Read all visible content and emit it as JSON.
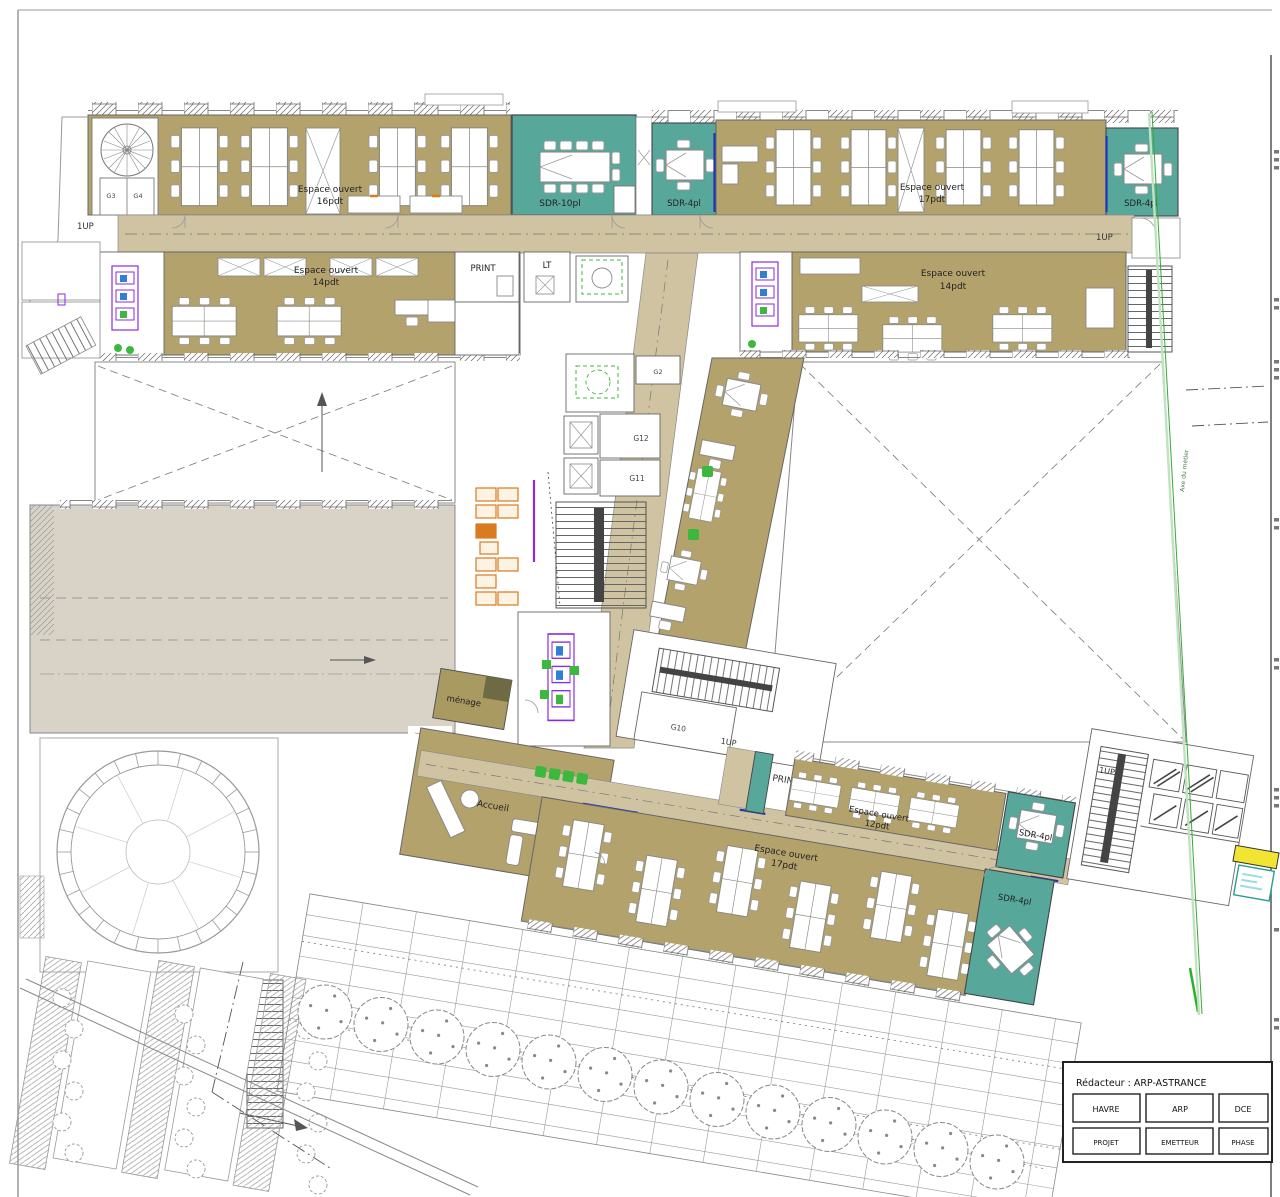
{
  "sheet": {
    "title_block": {
      "redacteur": "Rédacteur : ARP-ASTRANCE",
      "row1": [
        "HAVRE",
        "ARP",
        "DCE"
      ],
      "row2": [
        "PROJET",
        "EMETTEUR",
        "PHASE"
      ]
    },
    "axis_label": "Axe du métier"
  },
  "rooms": {
    "open_16": {
      "name": "Espace ouvert",
      "capacity": "16pdt"
    },
    "open_17_top": {
      "name": "Espace ouvert",
      "capacity": "17pdt"
    },
    "open_14_left": {
      "name": "Espace ouvert",
      "capacity": "14pdt"
    },
    "open_14_right": {
      "name": "Espace ouvert",
      "capacity": "14pdt"
    },
    "open_12": {
      "name": "Espace ouvert",
      "capacity": "12pdt"
    },
    "open_17_bottom": {
      "name": "Espace ouvert",
      "capacity": "17pdt"
    },
    "sdr10": {
      "label": "SDR-10pl"
    },
    "sdr4_top_left": {
      "label": "SDR-4pl"
    },
    "sdr4_top_right": {
      "label": "SDR-4pl"
    },
    "sdr4_mid": {
      "label": "SDR-4pl"
    },
    "sdr4_bottom": {
      "label": "SDR-4pl"
    },
    "accueil": {
      "label": "Accueil"
    },
    "menage": {
      "label": "ménage"
    },
    "print_top": {
      "label": "PRINT"
    },
    "print_bottom": {
      "label": "PRINT"
    },
    "lt_top": {
      "label": "LT"
    },
    "lt_bottom": {
      "label": "LT"
    },
    "g2": {
      "label": "G2"
    },
    "g3": {
      "label": "G3"
    },
    "g4": {
      "label": "G4"
    },
    "g10": {
      "label": "G10"
    },
    "g11": {
      "label": "G11"
    },
    "g12": {
      "label": "G12"
    }
  },
  "annotations": {
    "up_top_left": "1UP",
    "up_top_right": "1UP",
    "up_mid": "1UP",
    "up_bottom_mid": "1UP",
    "up_bottom_right": "1UP"
  },
  "colors": {
    "office": "#b3a26c",
    "corridor": "#cfc3a1",
    "meeting": "#57a79a",
    "hall_gray": "#d9d3c7",
    "accent_blue": "#2233bb",
    "sanitary_purple": "#8a2be2",
    "plant_green": "#3cb83c",
    "locker_orange": "#d97b1f",
    "highlight_yellow": "#f2e532",
    "menage_olive": "#a89a61"
  }
}
